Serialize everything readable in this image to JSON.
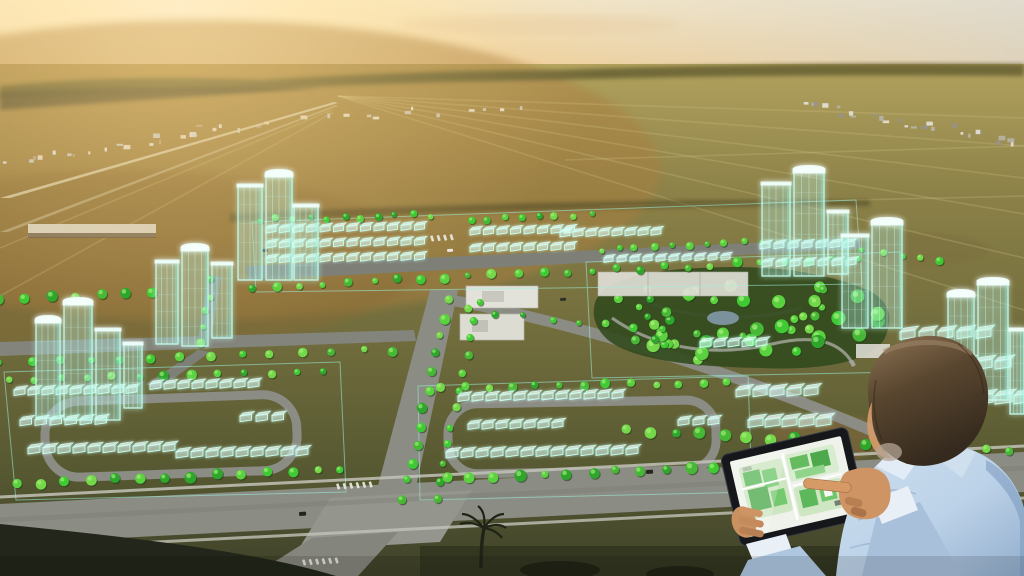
{
  "scene": {
    "type": "aerial-photo-composite",
    "description": "Aerial sunset view of vacant land with a glowing augmented-reality master plan of a future residential community; a planner in a light blue shirt reviews the site plan on a tablet.",
    "time_of_day": "sunset",
    "elements": [
      "sunset sky",
      "sun glow",
      "distant town",
      "open fields",
      "holographic master plan",
      "wireframe towers",
      "wireframe houses",
      "street trees",
      "central park with pond",
      "road network",
      "intersection with crosswalks",
      "palm tree",
      "planner holding tablet",
      "tablet showing green site plan"
    ]
  },
  "colors": {
    "sun_core": "#fffdf2",
    "sun_glow": "#ffe9b0",
    "sky_warm": "#f2d29c",
    "sky_top": "#f4e8cc",
    "sky_cool": "#d9d8d2",
    "field_far": "#a89a5c",
    "field_mid": "#77713f",
    "field_near": "#46492c",
    "field_sunlit": "#a97f3f",
    "hologram": "#c9fff1",
    "hologram_glow": "#74f2da",
    "tree_green": "#46c838",
    "park_base": "#324a1e",
    "road_gray": "#8b8c84",
    "sidewalk": "#c2c3b8",
    "pond_blue": "#7e95a3",
    "shirt_blue": "#bcd2e8",
    "shirt_shadow": "#9db8d6",
    "skin": "#c9915f",
    "hair_brown": "#59462f",
    "tablet_bezel": "#15171b",
    "tablet_screen": "#eef2ea",
    "plan_green": "#5cb85a",
    "plan_light_green": "#cfe6c2"
  }
}
